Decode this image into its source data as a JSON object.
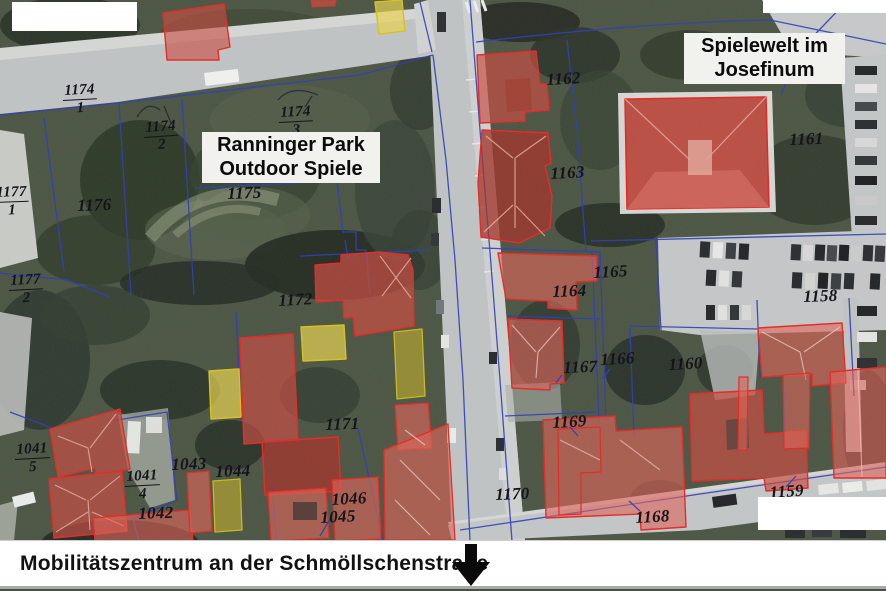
{
  "map": {
    "title_callouts": {
      "park": {
        "line1": "Ranninger Park",
        "line2": "Outdoor Spiele"
      },
      "josefinum": {
        "line1": "Spielewelt im",
        "line2": "Josefinum"
      }
    },
    "caption_bar": {
      "text": "Mobilitätszentrum an der Schmöllschenstraße"
    },
    "icons": {
      "caption_arrow": "down-arrow"
    },
    "overlay_colors": {
      "building_highlight_red": "#e3241e",
      "building_highlight_yellow": "#d8c018",
      "parcel_boundary_blue": "#2837b5"
    },
    "parcels": [
      {
        "id": "1174-1",
        "label": "1174",
        "den": "1",
        "x": 62,
        "y": 83,
        "rot": -3
      },
      {
        "id": "1174-2",
        "label": "1174",
        "den": "2",
        "x": 143,
        "y": 120,
        "rot": -4
      },
      {
        "id": "1174-3",
        "label": "1174",
        "den": "3",
        "x": 278,
        "y": 105,
        "rot": -3
      },
      {
        "id": "1177-1",
        "label": "1177",
        "den": "1",
        "x": -6,
        "y": 185,
        "rot": -2
      },
      {
        "id": "1177-2",
        "label": "1177",
        "den": "2",
        "x": 8,
        "y": 273,
        "rot": -3
      },
      {
        "id": "1041-5",
        "label": "1041",
        "den": "5",
        "x": 14,
        "y": 442,
        "rot": -3
      },
      {
        "id": "1041-4",
        "label": "1041",
        "den": "4",
        "x": 124,
        "y": 469,
        "rot": -3
      },
      {
        "id": "1176",
        "label": "1176",
        "x": 77,
        "y": 197,
        "rot": -2
      },
      {
        "id": "1175",
        "label": "1175",
        "x": 227,
        "y": 185,
        "rot": -2
      },
      {
        "id": "1172",
        "label": "1172",
        "x": 278,
        "y": 292,
        "rot": -3
      },
      {
        "id": "1171",
        "label": "1171",
        "x": 325,
        "y": 416,
        "rot": -2
      },
      {
        "id": "1162",
        "label": "1162",
        "x": 546,
        "y": 71,
        "rot": -3
      },
      {
        "id": "1163",
        "label": "1163",
        "x": 550,
        "y": 165,
        "rot": -3
      },
      {
        "id": "1161",
        "label": "1161",
        "x": 789,
        "y": 131,
        "rot": -2
      },
      {
        "id": "1165",
        "label": "1165",
        "x": 593,
        "y": 264,
        "rot": -3
      },
      {
        "id": "1164",
        "label": "1164",
        "x": 552,
        "y": 283,
        "rot": -2
      },
      {
        "id": "1166",
        "label": "1166",
        "x": 600,
        "y": 351,
        "rot": -3
      },
      {
        "id": "1167",
        "label": "1167",
        "x": 563,
        "y": 359,
        "rot": -2
      },
      {
        "id": "1160",
        "label": "1160",
        "x": 668,
        "y": 356,
        "rot": -3
      },
      {
        "id": "1158",
        "label": "1158",
        "x": 803,
        "y": 288,
        "rot": -2
      },
      {
        "id": "1169",
        "label": "1169",
        "x": 552,
        "y": 414,
        "rot": -3
      },
      {
        "id": "1170",
        "label": "1170",
        "x": 495,
        "y": 486,
        "rot": -2
      },
      {
        "id": "1168",
        "label": "1168",
        "x": 635,
        "y": 509,
        "rot": -3
      },
      {
        "id": "1159",
        "label": "1159",
        "x": 769,
        "y": 484,
        "rot": -4
      },
      {
        "id": "1043",
        "label": "1043",
        "x": 171,
        "y": 456,
        "rot": -2
      },
      {
        "id": "1044",
        "label": "1044",
        "x": 215,
        "y": 463,
        "rot": -2
      },
      {
        "id": "1042",
        "label": "1042",
        "x": 138,
        "y": 505,
        "rot": -2
      },
      {
        "id": "1046",
        "label": "1046",
        "x": 331,
        "y": 491,
        "rot": -3
      },
      {
        "id": "1045",
        "label": "1045",
        "x": 320,
        "y": 509,
        "rot": -3
      }
    ]
  }
}
